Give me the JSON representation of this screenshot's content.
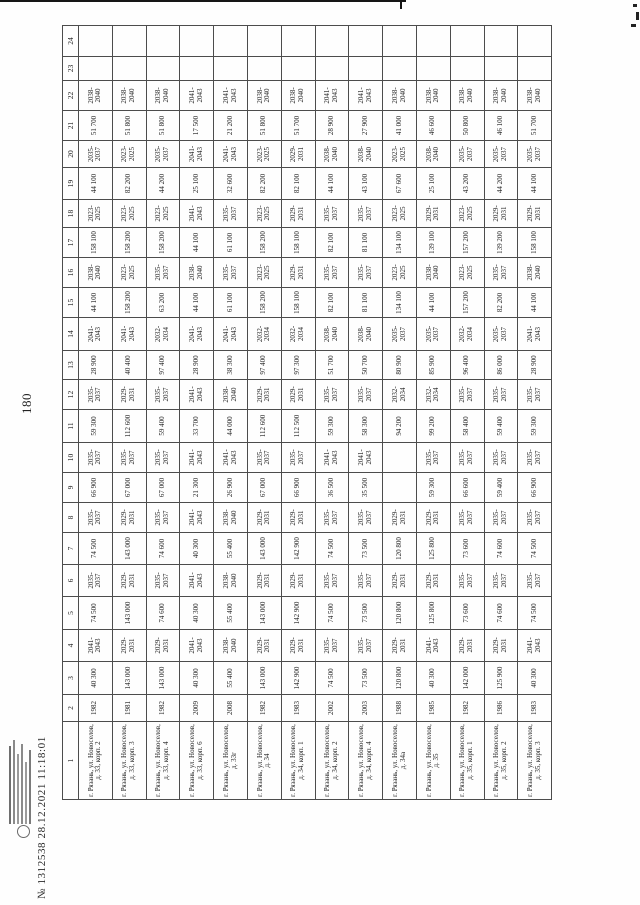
{
  "page": {
    "number": "180",
    "stamp_line": "№ 1312538 28.12.2021 11:18:01"
  },
  "table": {
    "column_numbers": [
      "1",
      "2",
      "3",
      "4",
      "5",
      "6",
      "7",
      "8",
      "9",
      "10",
      "11",
      "12",
      "13",
      "14",
      "15",
      "16",
      "17",
      "18",
      "19",
      "20",
      "21",
      "22",
      "23",
      "24"
    ],
    "rows": [
      {
        "address": "г. Рязань, ул. Новоселов, д. 33, корп. 2",
        "year": "1982",
        "values": [
          "40 300",
          "2041-2043",
          "74 500",
          "2035-2037",
          "74 500",
          "2035-2037",
          "66 900",
          "2035-2037",
          "59 300",
          "2035-2037",
          "28 900",
          "2041-2043",
          "44 100",
          "2038-2040",
          "158 100",
          "2023-2025",
          "44 100",
          "2035-2037",
          "51 700",
          "2038-2040",
          "",
          ""
        ]
      },
      {
        "address": "г. Рязань, ул. Новоселов, д. 33, корп. 3",
        "year": "1981",
        "values": [
          "143 000",
          "2029-2031",
          "143 000",
          "2029-2031",
          "143 000",
          "2029-2031",
          "67 000",
          "2035-2037",
          "112 600",
          "2029-2031",
          "40 400",
          "2041-2043",
          "158 200",
          "2023-2025",
          "158 200",
          "2023-2025",
          "82 200",
          "2023-2025",
          "51 800",
          "2038-2040",
          "",
          ""
        ]
      },
      {
        "address": "г. Рязань, ул. Новоселов, д. 33, корп. 4",
        "year": "1982",
        "values": [
          "143 000",
          "2029-2031",
          "74 600",
          "2035-2037",
          "74 600",
          "2035-2037",
          "67 000",
          "2035-2037",
          "59 400",
          "2035-2037",
          "97 400",
          "2032-2034",
          "63 200",
          "2035-2037",
          "158 200",
          "2023-2025",
          "44 200",
          "2035-2037",
          "51 800",
          "2038-2040",
          "",
          ""
        ]
      },
      {
        "address": "г. Рязань, ул. Новоселов, д. 33, корп. 6",
        "year": "2009",
        "values": [
          "40 300",
          "2041-2043",
          "40 300",
          "2041-2043",
          "40 300",
          "2041-2043",
          "21 300",
          "2041-2043",
          "33 700",
          "2041-2043",
          "28 900",
          "2041-2043",
          "44 100",
          "2038-2040",
          "44 100",
          "2041-2043",
          "25 100",
          "2041-2043",
          "17 500",
          "2041-2043",
          "",
          ""
        ]
      },
      {
        "address": "г. Рязань, ул. Новоселов, д. 33г",
        "year": "2008",
        "values": [
          "55 400",
          "2038-2040",
          "55 400",
          "2038-2040",
          "55 400",
          "2038-2040",
          "26 900",
          "2041-2043",
          "44 000",
          "2038-2040",
          "38 300",
          "2041-2043",
          "61 100",
          "2035-2037",
          "61 100",
          "2035-2037",
          "32 600",
          "2041-2043",
          "21 200",
          "2041-2043",
          "",
          ""
        ]
      },
      {
        "address": "г. Рязань, ул. Новоселов, д. 34",
        "year": "1982",
        "values": [
          "143 000",
          "2029-2031",
          "143 000",
          "2029-2031",
          "143 000",
          "2029-2031",
          "67 000",
          "2035-2037",
          "112 600",
          "2029-2031",
          "97 400",
          "2032-2034",
          "158 200",
          "2023-2025",
          "158 200",
          "2023-2025",
          "82 200",
          "2023-2025",
          "51 800",
          "2038-2040",
          "",
          ""
        ]
      },
      {
        "address": "г. Рязань, ул. Новоселов, д. 34, корп. 1",
        "year": "1983",
        "values": [
          "142 900",
          "2029-2031",
          "142 900",
          "2029-2031",
          "142 900",
          "2029-2031",
          "66 900",
          "2035-2037",
          "112 500",
          "2029-2031",
          "97 300",
          "2032-2034",
          "158 100",
          "2029-2031",
          "158 100",
          "2029-2031",
          "82 100",
          "2029-2031",
          "51 700",
          "2038-2040",
          "",
          ""
        ]
      },
      {
        "address": "г. Рязань, ул. Новоселов, д. 34, корп. 2",
        "year": "2002",
        "values": [
          "74 500",
          "2035-2037",
          "74 500",
          "2035-2037",
          "74 500",
          "2035-2037",
          "36 500",
          "2041-2043",
          "59 300",
          "2035-2037",
          "51 700",
          "2038-2040",
          "82 100",
          "2035-2037",
          "82 100",
          "2035-2037",
          "44 100",
          "2038-2040",
          "28 900",
          "2041-2043",
          "",
          ""
        ]
      },
      {
        "address": "г. Рязань, ул. Новоселов, д. 34, корп. 4",
        "year": "2003",
        "values": [
          "73 500",
          "2035-2037",
          "73 500",
          "2035-2037",
          "73 500",
          "2035-2037",
          "35 500",
          "2041-2043",
          "58 300",
          "2035-2037",
          "50 700",
          "2038-2040",
          "81 100",
          "2035-2037",
          "81 100",
          "2035-2037",
          "43 100",
          "2038-2040",
          "27 900",
          "2041-2043",
          "",
          ""
        ]
      },
      {
        "address": "г. Рязань, ул. Новоселов, д. 34а",
        "year": "1988",
        "values": [
          "120 800",
          "2029-2031",
          "120 800",
          "2029-2031",
          "120 800",
          "2029-2031",
          "",
          "",
          "94 200",
          "2032-2034",
          "80 900",
          "2035-2037",
          "134 100",
          "2023-2025",
          "134 100",
          "2023-2025",
          "67 600",
          "2023-2025",
          "41 000",
          "2038-2040",
          "",
          ""
        ]
      },
      {
        "address": "г. Рязань, ул. Новоселов, д. 35",
        "year": "1985",
        "values": [
          "40 300",
          "2041-2043",
          "125 800",
          "2029-2031",
          "125 800",
          "2029-2031",
          "59 300",
          "2035-2037",
          "99 200",
          "2032-2034",
          "85 900",
          "2035-2037",
          "44 100",
          "2038-2040",
          "139 100",
          "2029-2031",
          "25 100",
          "2038-2040",
          "46 600",
          "2038-2040",
          "",
          ""
        ]
      },
      {
        "address": "г. Рязань, ул. Новоселов, д. 35, корп. 1",
        "year": "1982",
        "values": [
          "142 000",
          "2029-2031",
          "73 600",
          "2035-2037",
          "73 600",
          "2035-2037",
          "66 600",
          "2035-2037",
          "58 400",
          "2035-2037",
          "96 400",
          "2032-2034",
          "157 200",
          "2023-2025",
          "157 200",
          "2023-2025",
          "43 200",
          "2035-2037",
          "50 800",
          "2038-2040",
          "",
          ""
        ]
      },
      {
        "address": "г. Рязань, ул. Новоселов, д. 35, корп. 2",
        "year": "1986",
        "values": [
          "125 900",
          "2029-2031",
          "74 600",
          "2035-2037",
          "74 600",
          "2035-2037",
          "59 400",
          "2035-2037",
          "59 400",
          "2035-2037",
          "86 000",
          "2035-2037",
          "82 200",
          "2035-2037",
          "139 200",
          "2029-2031",
          "44 200",
          "2035-2037",
          "46 100",
          "2038-2040",
          "",
          ""
        ]
      },
      {
        "address": "г. Рязань, ул. Новоселов, д. 35, корп. 3",
        "year": "1983",
        "values": [
          "40 300",
          "2041-2043",
          "74 500",
          "2035-2037",
          "74 500",
          "2035-2037",
          "66 900",
          "2035-2037",
          "59 300",
          "2035-2037",
          "28 900",
          "2041-2043",
          "44 100",
          "2038-2040",
          "158 100",
          "2029-2031",
          "44 100",
          "2035-2037",
          "51 700",
          "2038-2040",
          "",
          ""
        ]
      }
    ]
  }
}
